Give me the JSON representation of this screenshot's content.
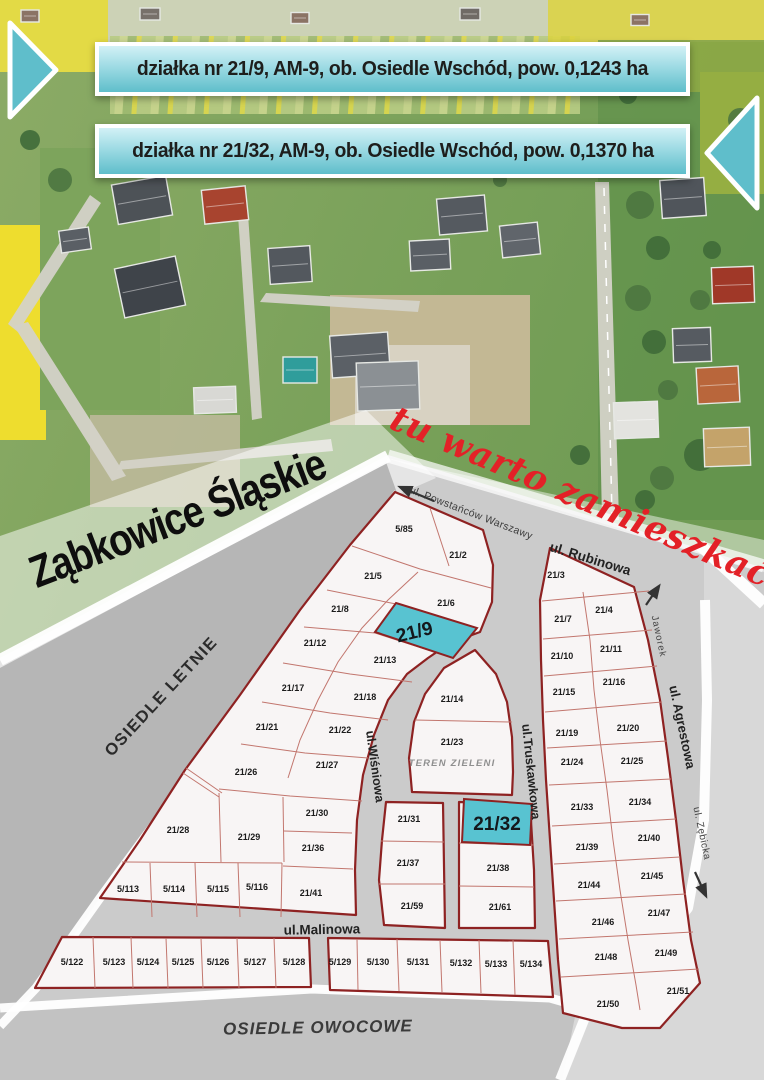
{
  "banners": {
    "banner1": "działka nr 21/9, AM-9, ob. Osiedle Wschód, pow. 0,1243 ha",
    "banner2": "działka nr 21/32, AM-9, ob. Osiedle Wschód, pow. 0,1370 ha"
  },
  "titles": {
    "city": "Ząbkowice Śląskie",
    "slogan": "tu warto zamieszkać!"
  },
  "colors": {
    "banner_teal": "#5fbecb",
    "highlight_teal": "#58c3d1",
    "parcel_fill": "#f8f5f5",
    "parcel_border": "#8e2222",
    "inner_line": "#c2766e",
    "street_gray": "#cbcbcb",
    "band_gray": "#b6b6b6",
    "margin_gray": "#d8d8d8",
    "owocowe_gray": "#c2c2c2",
    "slogan_red": "#e32127"
  },
  "pointers": [
    {
      "name": "banner1-arrow-right",
      "points": "10,23 56,70 10,117"
    },
    {
      "name": "banner2-arrow-left",
      "points": "757,98 707,153 757,208"
    }
  ],
  "photo": {
    "fields": [
      {
        "x": 0,
        "y": 0,
        "w": 764,
        "h": 42,
        "fill": "#ccd2b6"
      },
      {
        "x": 110,
        "y": 36,
        "w": 470,
        "h": 78,
        "fill": "url(#crops)",
        "o": 0.9
      },
      {
        "x": 0,
        "y": 0,
        "w": 108,
        "h": 72,
        "fill": "#e3da45"
      },
      {
        "x": 548,
        "y": 0,
        "w": 216,
        "h": 92,
        "fill": "#dcd33f",
        "o": 0.85
      },
      {
        "x": 700,
        "y": 72,
        "w": 64,
        "h": 122,
        "fill": "#e8dc38"
      },
      {
        "x": 0,
        "y": 225,
        "w": 46,
        "h": 215,
        "fill": "#eedd2e"
      },
      {
        "x": 40,
        "y": 148,
        "w": 120,
        "h": 262,
        "fill": "#7da45c"
      },
      {
        "x": 598,
        "y": 40,
        "w": 166,
        "h": 480,
        "fill": "#5d8f4a",
        "o": 0.6
      },
      {
        "x": 330,
        "y": 295,
        "w": 200,
        "h": 130,
        "fill": "#c7b998",
        "o": 0.95
      },
      {
        "x": 355,
        "y": 345,
        "w": 115,
        "h": 80,
        "fill": "#d8d2c2"
      },
      {
        "x": 90,
        "y": 415,
        "w": 150,
        "h": 92,
        "fill": "#c4bca1",
        "o": 0.8
      }
    ],
    "roads": [
      {
        "points": "595,182 609,182 619,520 602,520",
        "line": [
          604,
          188,
          612,
          514
        ]
      },
      {
        "points": "90,195 101,203 18,332 8,324"
      },
      {
        "points": "14,326 28,322 126,476 112,481"
      },
      {
        "points": "117,470 121,461 331,439 333,451"
      },
      {
        "points": "238,215 248,214 262,418 252,420"
      },
      {
        "points": "260,302 266,293 420,301 418,312"
      }
    ],
    "houses": [
      {
        "x": 30,
        "y": 16,
        "w": 18,
        "h": 12,
        "r": 0,
        "c": "#8b7365"
      },
      {
        "x": 150,
        "y": 14,
        "w": 20,
        "h": 12,
        "r": 0,
        "c": "#77706a"
      },
      {
        "x": 300,
        "y": 18,
        "w": 18,
        "h": 11,
        "r": 0,
        "c": "#8b7365"
      },
      {
        "x": 470,
        "y": 14,
        "w": 20,
        "h": 12,
        "r": 0,
        "c": "#6f6a66"
      },
      {
        "x": 640,
        "y": 20,
        "w": 18,
        "h": 11,
        "r": 0,
        "c": "#8b7365"
      },
      {
        "x": 142,
        "y": 200,
        "w": 55,
        "h": 40,
        "r": -10,
        "c": "#4d5257"
      },
      {
        "x": 225,
        "y": 205,
        "w": 44,
        "h": 34,
        "r": -6,
        "c": "#a8442f"
      },
      {
        "x": 290,
        "y": 265,
        "w": 42,
        "h": 36,
        "r": -4,
        "c": "#53585e"
      },
      {
        "x": 150,
        "y": 287,
        "w": 62,
        "h": 50,
        "r": -12,
        "c": "#3f444a"
      },
      {
        "x": 75,
        "y": 240,
        "w": 30,
        "h": 22,
        "r": -8,
        "c": "#5a5f65"
      },
      {
        "x": 360,
        "y": 355,
        "w": 58,
        "h": 42,
        "r": -4,
        "c": "#5b6066"
      },
      {
        "x": 300,
        "y": 370,
        "w": 34,
        "h": 26,
        "r": 0,
        "c": "#2f9d9b"
      },
      {
        "x": 430,
        "y": 255,
        "w": 40,
        "h": 30,
        "r": -3,
        "c": "#5a5f65"
      },
      {
        "x": 462,
        "y": 215,
        "w": 48,
        "h": 36,
        "r": -5,
        "c": "#555a60"
      },
      {
        "x": 520,
        "y": 240,
        "w": 38,
        "h": 32,
        "r": -6,
        "c": "#60656b"
      },
      {
        "x": 388,
        "y": 386,
        "w": 62,
        "h": 48,
        "r": -2,
        "c": "#8b9094"
      },
      {
        "x": 215,
        "y": 400,
        "w": 42,
        "h": 26,
        "r": -2,
        "c": "#d8d8d4"
      },
      {
        "x": 683,
        "y": 198,
        "w": 44,
        "h": 38,
        "r": -4,
        "c": "#50555b"
      },
      {
        "x": 733,
        "y": 285,
        "w": 42,
        "h": 36,
        "r": -2,
        "c": "#a03828"
      },
      {
        "x": 692,
        "y": 345,
        "w": 38,
        "h": 34,
        "r": -2,
        "c": "#565b61"
      },
      {
        "x": 718,
        "y": 385,
        "w": 42,
        "h": 36,
        "r": -3,
        "c": "#b9663b"
      },
      {
        "x": 636,
        "y": 420,
        "w": 44,
        "h": 36,
        "r": -2,
        "c": "#e3e3df"
      },
      {
        "x": 727,
        "y": 447,
        "w": 46,
        "h": 38,
        "r": -2,
        "c": "#c4a36a"
      }
    ],
    "trees": [
      [
        640,
        205,
        14
      ],
      [
        658,
        248,
        12
      ],
      [
        638,
        298,
        13
      ],
      [
        654,
        342,
        12
      ],
      [
        668,
        390,
        10
      ],
      [
        700,
        455,
        16
      ],
      [
        662,
        478,
        12
      ],
      [
        645,
        500,
        10
      ],
      [
        610,
        135,
        10
      ],
      [
        628,
        95,
        9
      ],
      [
        700,
        300,
        10
      ],
      [
        712,
        250,
        9
      ],
      [
        740,
        120,
        12
      ],
      [
        680,
        60,
        10
      ],
      [
        60,
        180,
        12
      ],
      [
        30,
        140,
        10
      ],
      [
        200,
        160,
        8
      ],
      [
        420,
        162,
        6
      ],
      [
        500,
        180,
        7
      ],
      [
        580,
        455,
        10
      ]
    ]
  },
  "map": {
    "bands": [
      {
        "name": "map-base",
        "points": "0,658 388,455 764,568 764,1080 0,1080",
        "fill": "#cbcbcb"
      },
      {
        "name": "photo-fade",
        "points": "386,458 764,540 764,572",
        "fill": "rgba(255,255,255,0.45)"
      },
      {
        "name": "title-band",
        "points": "0,536 366,410 436,478 0,668",
        "fill": "rgba(255,255,255,0.5)"
      },
      {
        "name": "letnie-band",
        "points": "0,668 386,462 397,493 100,898 38,986 0,1024",
        "fill": "#b6b6b6"
      },
      {
        "name": "right-margin",
        "points": "704,548 764,598 764,1080 560,1080 575,1010 622,962 657,947 686,910 703,820 706,700 704,600",
        "fill": "#d8d8d8"
      },
      {
        "name": "owocowe-band",
        "points": "0,1012 310,992 548,1000 576,1012 562,1080 0,1080",
        "fill": "#c2c2c2"
      }
    ],
    "white_strips": [
      {
        "points": "0,660 388,456",
        "w": 12
      },
      {
        "points": "388,456 764,566",
        "w": 13,
        "o": 0.7
      },
      {
        "points": "398,493 100,898 36,988 0,1026",
        "w": 9
      },
      {
        "points": "700,545 764,604",
        "w": 12
      },
      {
        "points": "0,1008 312,989 550,998 585,1008",
        "w": 9
      },
      {
        "points": "588,1010 560,1080",
        "w": 10
      },
      {
        "points": "585,1012 622,960 658,946 688,908 704,820 707,700 705,600",
        "w": 10
      }
    ],
    "blocks": [
      {
        "name": "block-nw",
        "points": "395,492 483,530 493,565 492,602 480,632 450,643 428,658 407,674 388,700 374,735 363,775 357,820 355,870 356,915 100,898 140,840 185,770 240,695 300,610 350,545"
      },
      {
        "name": "block-teren",
        "points": "475,650 496,674 507,702 512,737 513,772 512,795 412,792 409,758 414,722 425,694 444,668"
      },
      {
        "name": "block-c-west",
        "points": "386,802 443,803 445,928 384,925 379,880 382,840"
      },
      {
        "name": "block-c-east",
        "points": "459,802 530,805 534,870 535,928 459,928"
      },
      {
        "name": "block-east",
        "points": "550,548 634,587 648,640 660,700 668,758 676,820 683,880 691,940 700,983 660,1028 622,1028 563,1013 558,960 554,900 550,840 546,780 543,720 541,660 540,600"
      },
      {
        "name": "block-s-west",
        "points": "62,937 309,938 311,987 35,988"
      },
      {
        "name": "block-s-east",
        "points": "328,938 548,941 553,997 330,990"
      }
    ],
    "inner_lines": [
      "430,508 449,566",
      "352,546 420,569 491,588",
      "418,572 388,600 362,628 338,662 318,700 300,740 288,778",
      "327,590 396,604 477,628",
      "304,627 375,633 453,658",
      "283,663 350,674 412,682",
      "262,702 330,713 388,720",
      "241,744 305,753 368,758",
      "219,789 290,796 362,801",
      "186,768 222,793",
      "183,773 219,797",
      "219,793 221,862",
      "283,797 284,862",
      "284,831 352,833",
      "283,866 353,869",
      "122,862 282,863",
      "282,863 281,917",
      "150,863 152,917",
      "195,863 197,917",
      "238,863 240,917",
      "415,720 512,722",
      "381,841 444,842",
      "379,884 445,884",
      "459,843 534,845",
      "459,886 534,887",
      "542,601 649,591",
      "543,639 652,630",
      "544,676 657,666",
      "545,712 662,702",
      "547,748 667,741",
      "549,785 671,779",
      "552,826 676,819",
      "554,864 680,857",
      "556,901 686,894",
      "559,939 693,932",
      "561,977 699,969",
      "583,592 590,640 594,690 600,740 607,790 613,840 620,890 628,940 636,985 640,1010",
      "93,937 95,988",
      "131,937 133,988",
      "166,938 168,988",
      "201,938 203,988",
      "237,938 239,988",
      "274,938 276,988",
      "357,939 358,990",
      "397,939 399,991",
      "440,940 442,992",
      "479,940 481,993",
      "513,940 515,995"
    ],
    "highlights": [
      {
        "id": "21/9",
        "points": "396,603 477,628 453,658 375,632",
        "lx": 416,
        "ly": 638,
        "lr": -14
      },
      {
        "id": "21/32",
        "points": "464,799 532,804 530,845 462,842",
        "lx": 497,
        "ly": 830,
        "lr": 0
      }
    ],
    "parcels": [
      {
        "id": "5/85",
        "x": 404,
        "y": 532
      },
      {
        "id": "21/2",
        "x": 458,
        "y": 558
      },
      {
        "id": "21/5",
        "x": 373,
        "y": 579
      },
      {
        "id": "21/6",
        "x": 446,
        "y": 606
      },
      {
        "id": "21/8",
        "x": 340,
        "y": 612
      },
      {
        "id": "21/12",
        "x": 315,
        "y": 646
      },
      {
        "id": "21/13",
        "x": 385,
        "y": 663
      },
      {
        "id": "21/17",
        "x": 293,
        "y": 691
      },
      {
        "id": "21/18",
        "x": 365,
        "y": 700
      },
      {
        "id": "21/21",
        "x": 267,
        "y": 730
      },
      {
        "id": "21/22",
        "x": 340,
        "y": 733
      },
      {
        "id": "21/26",
        "x": 246,
        "y": 775
      },
      {
        "id": "21/27",
        "x": 327,
        "y": 768
      },
      {
        "id": "21/28",
        "x": 178,
        "y": 833
      },
      {
        "id": "21/29",
        "x": 249,
        "y": 840
      },
      {
        "id": "21/30",
        "x": 317,
        "y": 816
      },
      {
        "id": "21/36",
        "x": 313,
        "y": 851
      },
      {
        "id": "21/41",
        "x": 311,
        "y": 896
      },
      {
        "id": "5/113",
        "x": 128,
        "y": 892
      },
      {
        "id": "5/114",
        "x": 174,
        "y": 892
      },
      {
        "id": "5/115",
        "x": 218,
        "y": 892
      },
      {
        "id": "5/116",
        "x": 257,
        "y": 890
      },
      {
        "id": "21/14",
        "x": 452,
        "y": 702
      },
      {
        "id": "21/23",
        "x": 452,
        "y": 745
      },
      {
        "id": "21/31",
        "x": 409,
        "y": 822
      },
      {
        "id": "21/37",
        "x": 408,
        "y": 866
      },
      {
        "id": "21/59",
        "x": 412,
        "y": 909
      },
      {
        "id": "21/38",
        "x": 498,
        "y": 871
      },
      {
        "id": "21/61",
        "x": 500,
        "y": 910
      },
      {
        "id": "21/3",
        "x": 556,
        "y": 578
      },
      {
        "id": "21/7",
        "x": 563,
        "y": 622
      },
      {
        "id": "21/4",
        "x": 604,
        "y": 613
      },
      {
        "id": "21/10",
        "x": 562,
        "y": 659
      },
      {
        "id": "21/11",
        "x": 611,
        "y": 652
      },
      {
        "id": "21/15",
        "x": 564,
        "y": 695
      },
      {
        "id": "21/16",
        "x": 614,
        "y": 685
      },
      {
        "id": "21/19",
        "x": 567,
        "y": 736
      },
      {
        "id": "21/20",
        "x": 628,
        "y": 731
      },
      {
        "id": "21/24",
        "x": 572,
        "y": 765
      },
      {
        "id": "21/25",
        "x": 632,
        "y": 764
      },
      {
        "id": "21/33",
        "x": 582,
        "y": 810
      },
      {
        "id": "21/34",
        "x": 640,
        "y": 805
      },
      {
        "id": "21/39",
        "x": 587,
        "y": 850
      },
      {
        "id": "21/40",
        "x": 649,
        "y": 841
      },
      {
        "id": "21/44",
        "x": 589,
        "y": 888
      },
      {
        "id": "21/45",
        "x": 652,
        "y": 879
      },
      {
        "id": "21/46",
        "x": 603,
        "y": 925
      },
      {
        "id": "21/47",
        "x": 659,
        "y": 916
      },
      {
        "id": "21/48",
        "x": 606,
        "y": 960
      },
      {
        "id": "21/49",
        "x": 666,
        "y": 956
      },
      {
        "id": "21/50",
        "x": 608,
        "y": 1007
      },
      {
        "id": "21/51",
        "x": 678,
        "y": 994
      },
      {
        "id": "5/122",
        "x": 72,
        "y": 965
      },
      {
        "id": "5/123",
        "x": 114,
        "y": 965
      },
      {
        "id": "5/124",
        "x": 148,
        "y": 965
      },
      {
        "id": "5/125",
        "x": 183,
        "y": 965
      },
      {
        "id": "5/126",
        "x": 218,
        "y": 965
      },
      {
        "id": "5/127",
        "x": 255,
        "y": 965
      },
      {
        "id": "5/128",
        "x": 294,
        "y": 965
      },
      {
        "id": "5/129",
        "x": 340,
        "y": 965
      },
      {
        "id": "5/130",
        "x": 378,
        "y": 965
      },
      {
        "id": "5/131",
        "x": 418,
        "y": 965
      },
      {
        "id": "5/132",
        "x": 461,
        "y": 966
      },
      {
        "id": "5/133",
        "x": 496,
        "y": 967
      },
      {
        "id": "5/134",
        "x": 531,
        "y": 967
      }
    ],
    "street_labels": [
      {
        "text": "ul. Powstańców Warszawy",
        "x": 470,
        "y": 516,
        "rot": 21,
        "size": 10.5,
        "bold": 0,
        "color": "#3d3d3d",
        "sp": 0.3
      },
      {
        "text": "ul. Rubinowa",
        "x": 589,
        "y": 563,
        "rot": 17,
        "size": 13.5,
        "bold": 1,
        "color": "#222222",
        "sp": 0
      },
      {
        "text": "Jaworek",
        "x": 656,
        "y": 637,
        "rot": 78,
        "size": 9.5,
        "bold": 0,
        "color": "#444444",
        "sp": 1
      },
      {
        "text": "ul. Agrestowa",
        "x": 678,
        "y": 728,
        "rot": 78,
        "size": 13,
        "bold": 1,
        "color": "#222222",
        "sp": 0
      },
      {
        "text": "ul. Zębicka",
        "x": 699,
        "y": 834,
        "rot": 78,
        "size": 10,
        "bold": 0,
        "color": "#444444",
        "sp": 0.5
      },
      {
        "text": "ul.Wiśniowa",
        "x": 371,
        "y": 767,
        "rot": 82,
        "size": 12.5,
        "bold": 1,
        "color": "#222222",
        "sp": 0
      },
      {
        "text": "ul.Truskawkowa",
        "x": 527,
        "y": 772,
        "rot": 84,
        "size": 12.5,
        "bold": 1,
        "color": "#222222",
        "sp": 0
      },
      {
        "text": "ul.Malinowa",
        "x": 322,
        "y": 934,
        "rot": -1,
        "size": 13.5,
        "bold": 1,
        "color": "#222222",
        "sp": 0
      }
    ],
    "area_labels": [
      {
        "text": "OSIEDLE LETNIE",
        "x": 165,
        "y": 700,
        "rot": -47,
        "size": 16.5,
        "color": "#2b2b2b",
        "italic": 0,
        "sp": 1.5
      },
      {
        "text": "OSIEDLE OWOCOWE",
        "x": 318,
        "y": 1033,
        "rot": -1,
        "size": 17,
        "color": "#3a3a3a",
        "italic": 1,
        "sp": 1
      },
      {
        "text": "TEREN ZIELENI",
        "x": 452,
        "y": 766,
        "rot": 0,
        "size": 9.5,
        "color": "#8f8f8f",
        "italic": 1,
        "sp": 1.2
      }
    ],
    "arrows": [
      {
        "name": "powstancow-arrow",
        "x1": 434,
        "y1": 501,
        "x2": 400,
        "y2": 487
      },
      {
        "name": "jaworek-arrow",
        "x1": 646,
        "y1": 605,
        "x2": 659,
        "y2": 586
      },
      {
        "name": "zebicka-arrow",
        "x1": 695,
        "y1": 872,
        "x2": 706,
        "y2": 896
      }
    ]
  }
}
